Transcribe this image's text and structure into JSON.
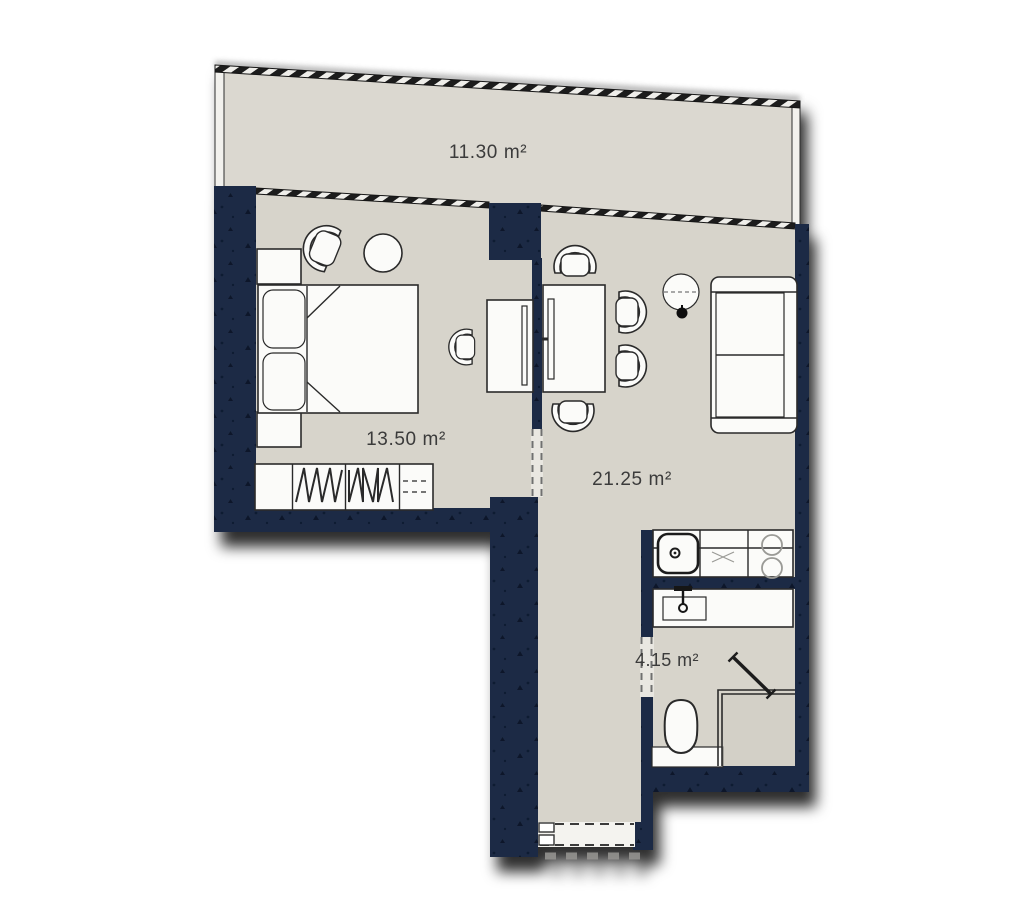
{
  "floor_plan": {
    "balcony": {
      "name": "balcony",
      "label": "11.30 m²"
    },
    "bedroom": {
      "name": "bedroom",
      "label": "13.50 m²"
    },
    "living_room": {
      "name": "living-room",
      "label": "21.25 m²"
    },
    "bathroom": {
      "name": "bathroom",
      "label": "4.15 m²"
    },
    "colors": {
      "wall_navy": "#1e2b45",
      "wall_speckle": "#0e1729",
      "floor_beige": "#d7d4cb",
      "balcony_floor": "#dbd8d0",
      "furniture_white": "#fbfbf9",
      "outline_dark": "#2b2b2b",
      "label_text": "#3a3a3a",
      "background": "#ffffff"
    }
  }
}
